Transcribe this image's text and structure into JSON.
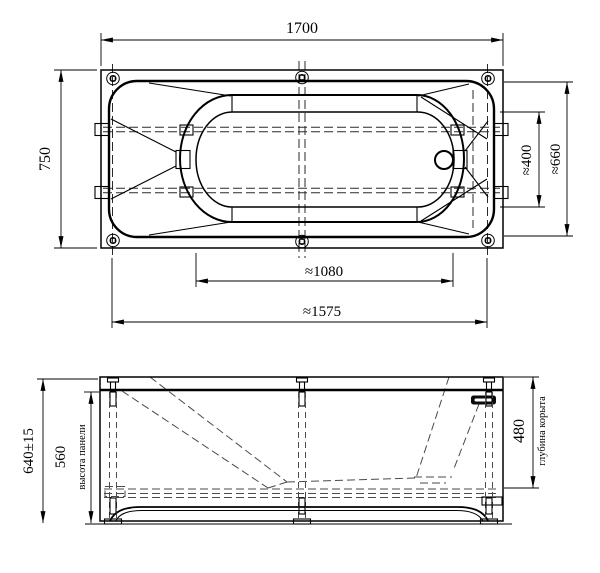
{
  "colors": {
    "line": "#000000",
    "hidden_line": "#4a4a4a",
    "background": "#ffffff"
  },
  "top_view": {
    "length": "1700",
    "width": "750",
    "bottom_width_at_drain": "≈400",
    "rim_width_at_drain": "≈660",
    "bottom_length": "≈1080",
    "feet_span": "≈1575"
  },
  "side_view": {
    "overall_height": "640±15",
    "panel_height": "560",
    "panel_height_label": "высота панели",
    "bowl_depth": "480",
    "bowl_depth_label": "глубина корыта"
  }
}
